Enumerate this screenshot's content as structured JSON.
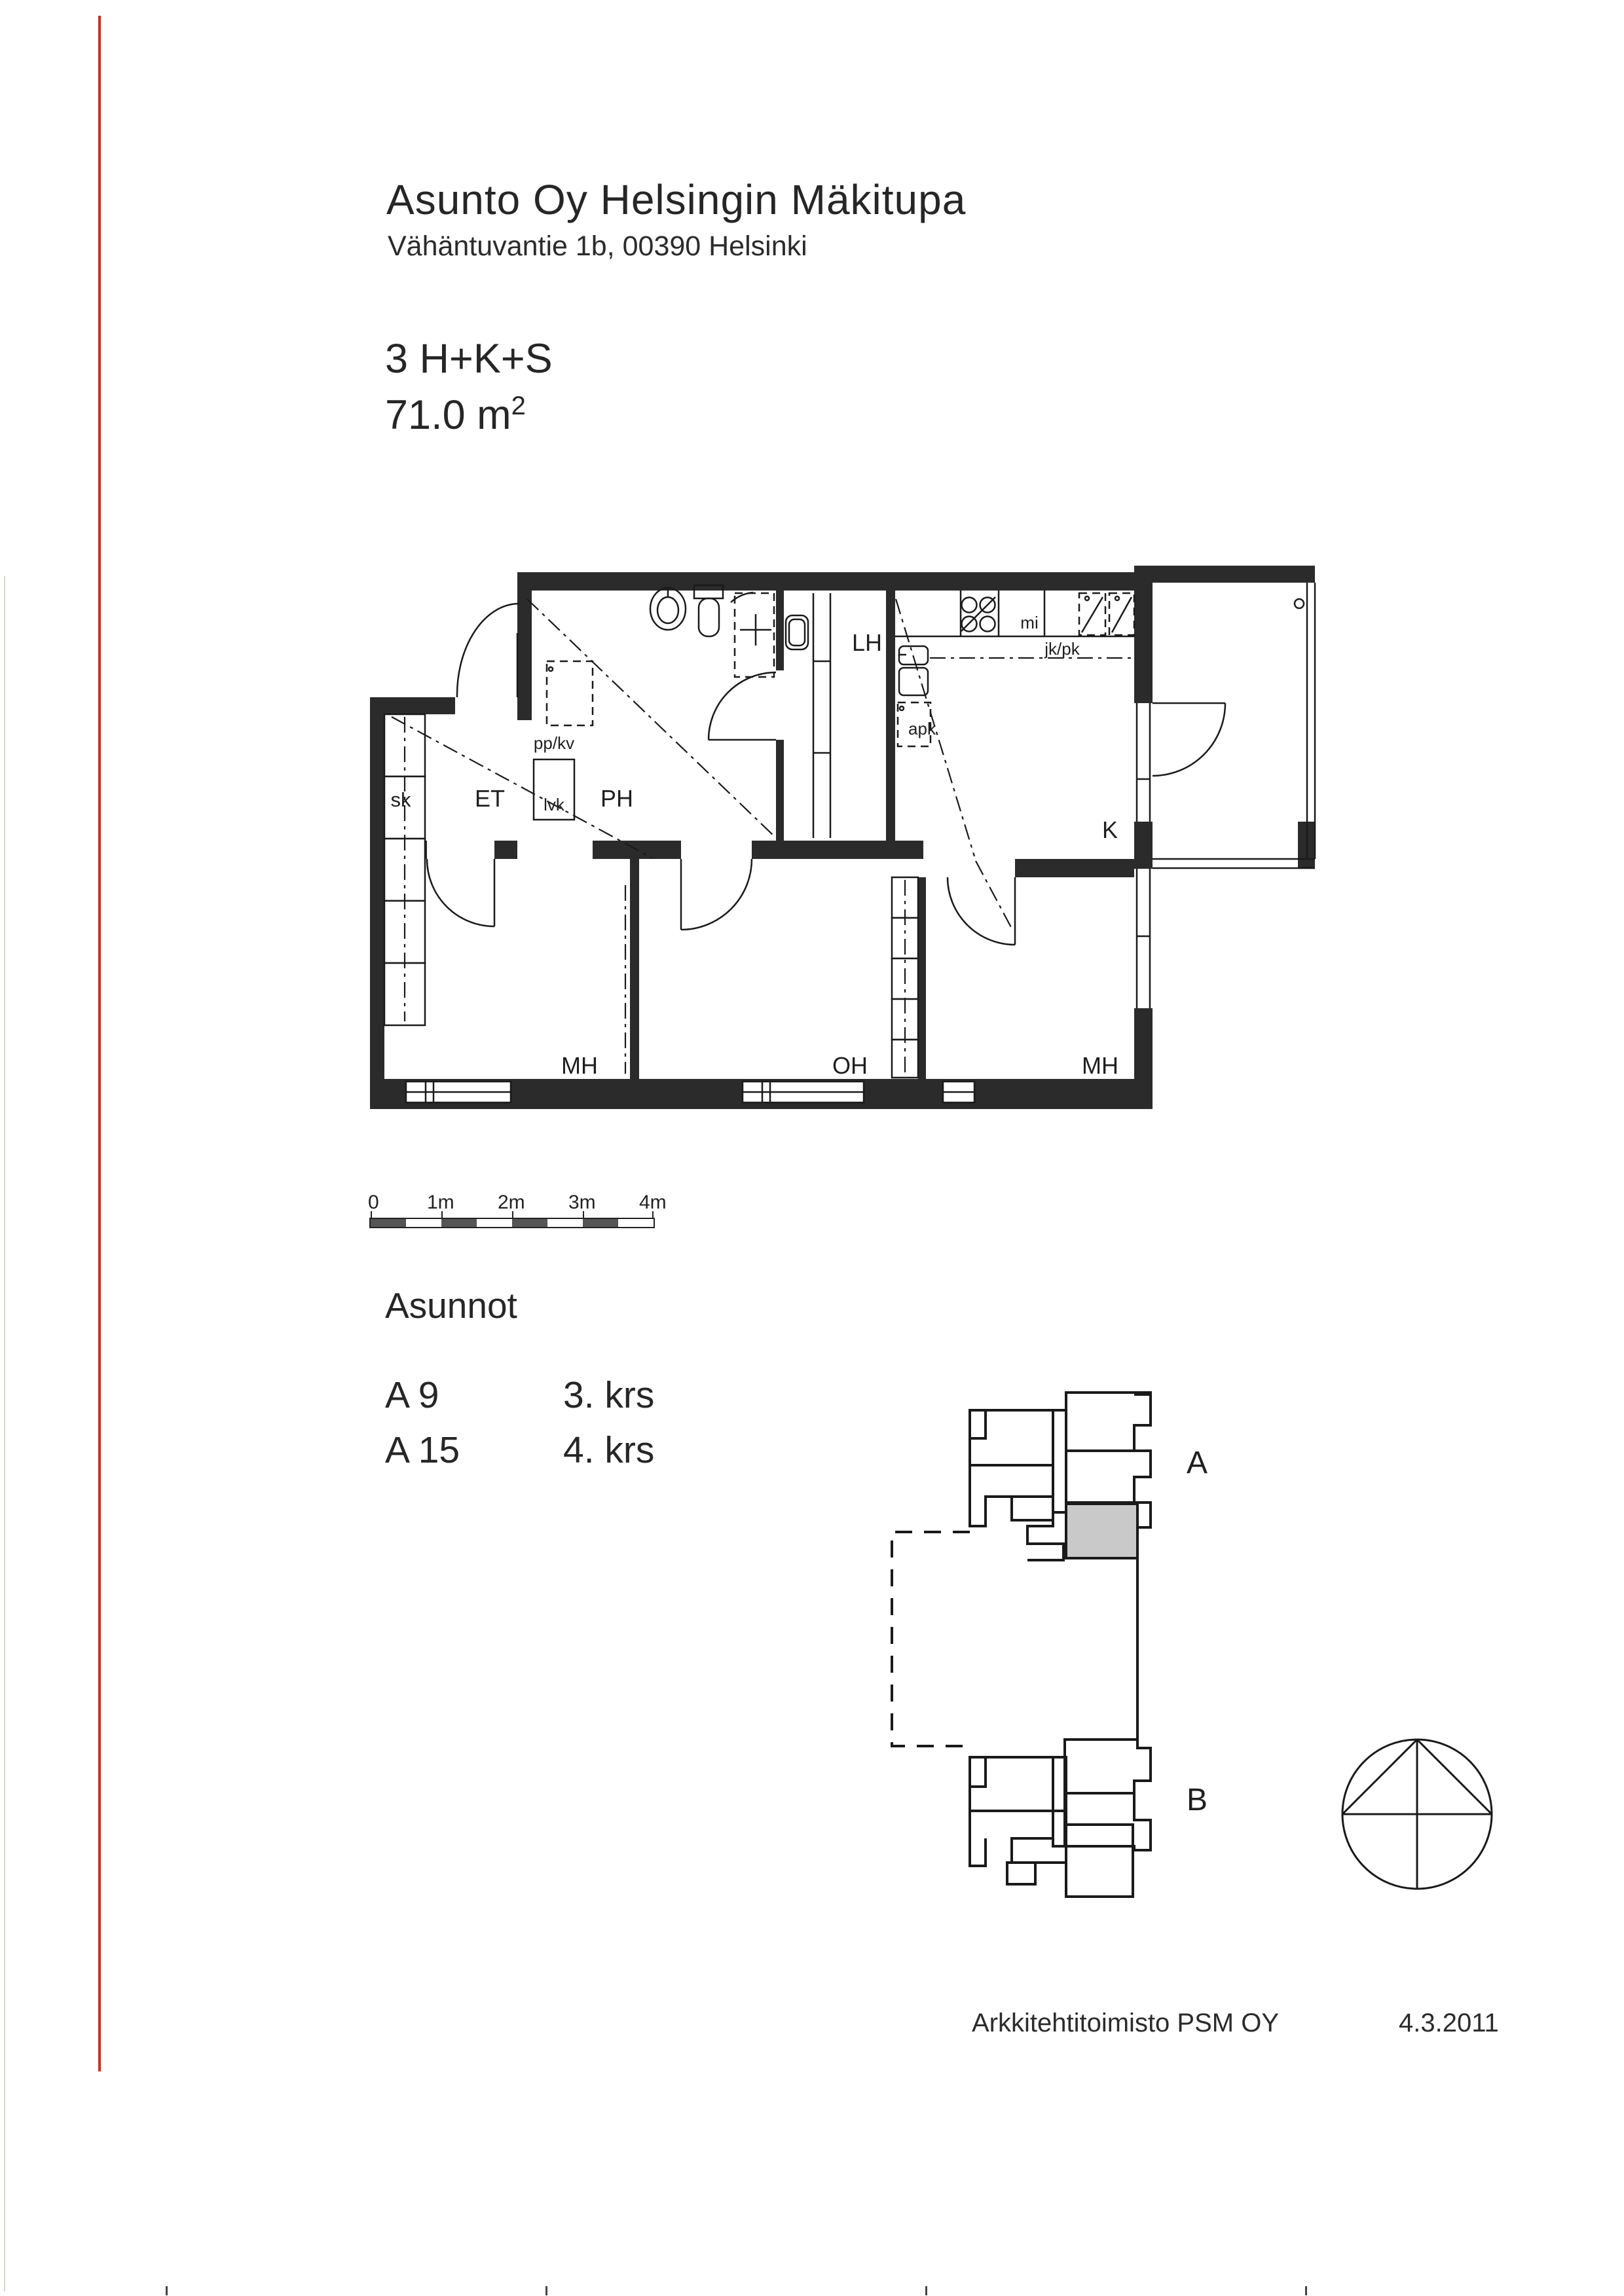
{
  "page": {
    "title": "Asunto Oy Helsingin Mäkitupa",
    "address": "Vähäntuvantie 1b, 00390 Helsinki",
    "apartment_type": "3 H+K+S",
    "area_value": "71.0 m",
    "area_exponent": "2",
    "section_heading": "Asunnot",
    "apartments": [
      {
        "id": "A 9",
        "floor": "3. krs"
      },
      {
        "id": "A 15",
        "floor": "4. krs"
      }
    ],
    "footer": {
      "architect": "Arkkitehtitoimisto PSM OY",
      "date": "4.3.2011"
    }
  },
  "floor_plan": {
    "labels": {
      "sk": "sk",
      "et": "ET",
      "ph": "PH",
      "lh": "LH",
      "k": "K",
      "mh_left": "MH",
      "oh": "OH",
      "mh_right": "MH",
      "ppkv": "pp/kv",
      "lvk": "lvk",
      "apk": "apk",
      "mi": "mi",
      "jkpk": "jk/pk"
    }
  },
  "scale_bar": {
    "ticks": [
      "0",
      "1m",
      "2m",
      "3m",
      "4m"
    ]
  },
  "key_plan": {
    "building_a_label": "A",
    "building_b_label": "B"
  },
  "colors": {
    "wall": "#2b2b2b",
    "line": "#1a1a1a",
    "red_line": "#c23322",
    "unit_fill": "#c9c9c9"
  }
}
